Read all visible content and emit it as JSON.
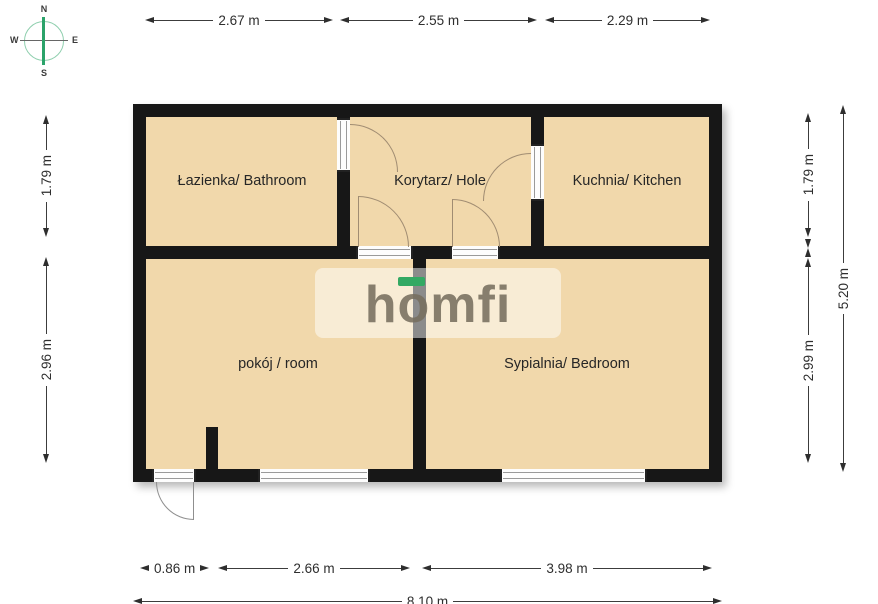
{
  "compass": {
    "north": "N",
    "south": "S",
    "east": "E",
    "west": "W"
  },
  "logo": {
    "text": "homfi",
    "accent_color": "#33a963",
    "text_color": "#766e5e"
  },
  "colors": {
    "floor": "#f1d8ab",
    "wall": "#171717",
    "door_arc": "#a08c72"
  },
  "rooms": [
    {
      "id": "bathroom",
      "label": "Łazienka/ Bathroom"
    },
    {
      "id": "hall",
      "label": "Korytarz/ Hole"
    },
    {
      "id": "kitchen",
      "label": "Kuchnia/ Kitchen"
    },
    {
      "id": "room",
      "label": "pokój / room"
    },
    {
      "id": "bedroom",
      "label": "Sypialnia/ Bedroom"
    }
  ],
  "dimensions": {
    "top": [
      {
        "label": "2.67 m"
      },
      {
        "label": "2.55 m"
      },
      {
        "label": "2.29 m"
      }
    ],
    "bottom": [
      {
        "label": "0.86 m"
      },
      {
        "label": "2.66 m"
      },
      {
        "label": "3.98 m"
      }
    ],
    "bottom_total": {
      "label": "8.10 m"
    },
    "left": [
      {
        "label": "1.79 m"
      },
      {
        "label": "2.96 m"
      }
    ],
    "right_inner": [
      {
        "label": "1.79 m"
      },
      {
        "label": "2.99 m"
      }
    ],
    "right_outer": {
      "label": "5.20 m"
    }
  }
}
